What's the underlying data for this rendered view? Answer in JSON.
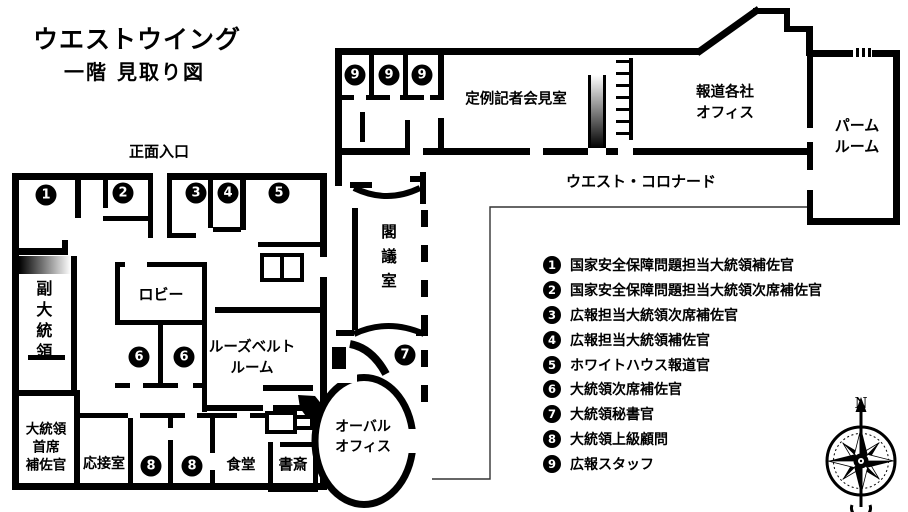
{
  "title": {
    "line1": "ウエストウイング",
    "line2": "一階 見取り図"
  },
  "plan": {
    "labels": {
      "front_entrance": "正面入口",
      "vice_president": "副大統領",
      "lobby": "ロビー",
      "roosevelt_room": "ルーズベルト\nルーム",
      "chief_of_staff": "大統領\n首席\n補佐官",
      "reception_room": "応接室",
      "dining_room": "食堂",
      "study": "書斎",
      "cabinet_room": "閣議室",
      "oval_office": "オーバル\nオフィス",
      "press_briefing_room": "定例記者会見室",
      "press_offices": "報道各社\nオフィス",
      "palm_room": "パーム\nルーム",
      "west_colonnade": "ウエスト・コロナード",
      "compass_north": "N"
    },
    "badges": [
      "1",
      "2",
      "3",
      "4",
      "5",
      "6",
      "6",
      "7",
      "8",
      "8",
      "9",
      "9",
      "9"
    ]
  },
  "legend": {
    "items": [
      {
        "num": "1",
        "label": "国家安全保障問題担当大統領補佐官"
      },
      {
        "num": "2",
        "label": "国家安全保障問題担当大統領次席補佐官"
      },
      {
        "num": "3",
        "label": "広報担当大統領次席補佐官"
      },
      {
        "num": "4",
        "label": "広報担当大統領補佐官"
      },
      {
        "num": "5",
        "label": "ホワイトハウス報道官"
      },
      {
        "num": "6",
        "label": "大統領次席補佐官"
      },
      {
        "num": "7",
        "label": "大統領秘書官"
      },
      {
        "num": "8",
        "label": "大統領上級顧問"
      },
      {
        "num": "9",
        "label": "広報スタッフ"
      }
    ]
  },
  "colors": {
    "wall": "#000000",
    "background": "#ffffff",
    "boundary_line": "#333333"
  }
}
